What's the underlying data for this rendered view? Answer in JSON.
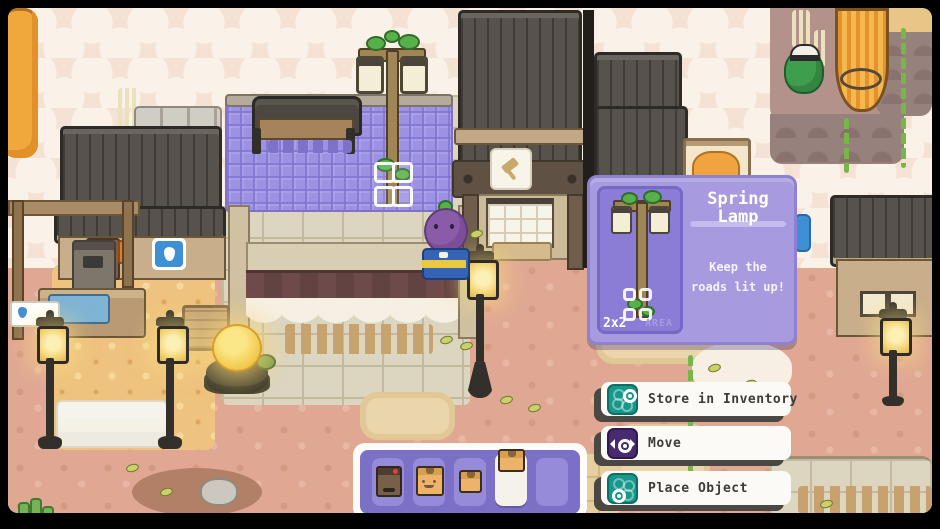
{
  "object_panel": {
    "title_line1": "Spring",
    "title_line2": "Lamp",
    "description_line1": "Keep the",
    "description_line2": "roads lit up!",
    "size_label": "2x2",
    "size_unit": "AREA",
    "preview_object": "spring-lamp",
    "colors": {
      "panel": "#a79ade",
      "preview": "#8b7cd6"
    }
  },
  "context_menu": {
    "items": [
      {
        "label": "Store in Inventory",
        "icon": "storage-icon",
        "icon_color": "#17988c"
      },
      {
        "label": "Move",
        "icon": "move-icon",
        "icon_color": "#472a70"
      },
      {
        "label": "Place Object",
        "icon": "place-icon",
        "icon_color": "#17988c"
      }
    ]
  },
  "hotbar": {
    "selected_index": 3,
    "slots": [
      {
        "item": "shipping-machine"
      },
      {
        "item": "crate-with-face"
      },
      {
        "item": "small-crate"
      },
      {
        "item": "crate"
      },
      {
        "item": null
      }
    ]
  },
  "world": {
    "selected_object": "spring-lamp",
    "placement_grid": "2x2",
    "colors": {
      "tarp": "#9d92e2",
      "terracotta": "#e0a893",
      "stone": "#dcd5c0",
      "sand": "#eec37f"
    }
  }
}
